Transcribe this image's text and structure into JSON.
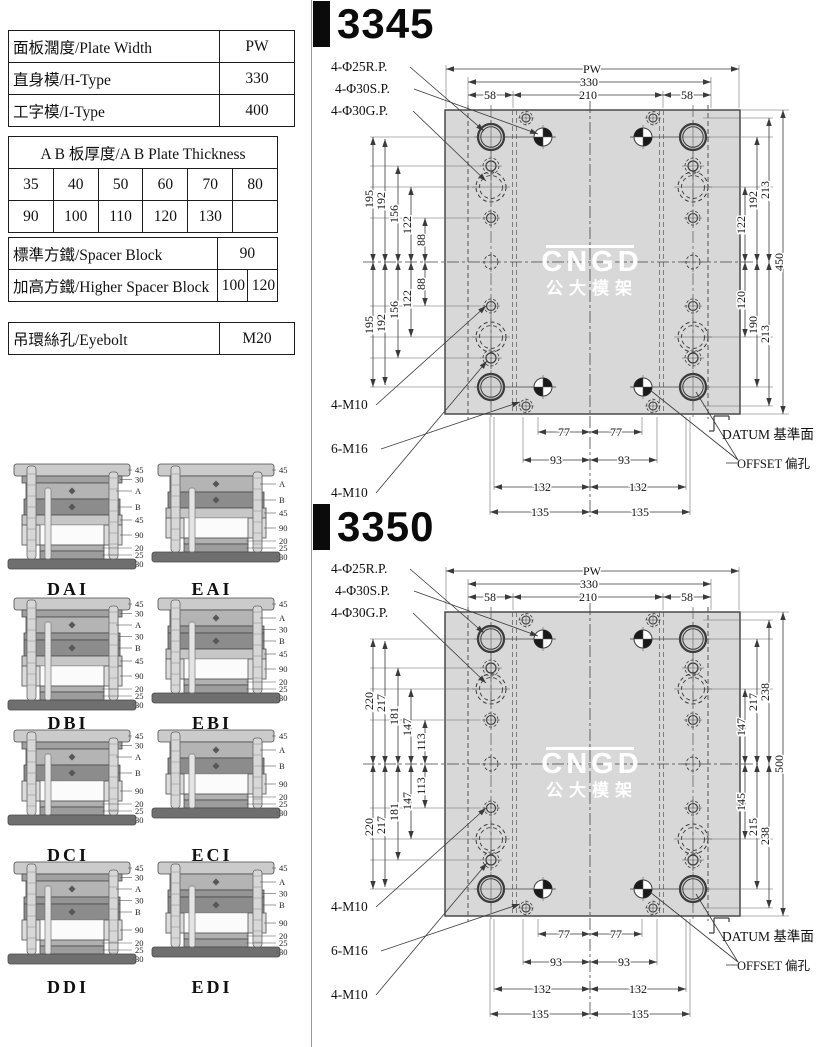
{
  "colors": {
    "plate": "#d8d8d8",
    "line": "#3a3a3a",
    "title_black": "#0b0b0b"
  },
  "spec_table": {
    "rows": [
      {
        "label": "面板濶度/Plate Width",
        "value": "PW"
      },
      {
        "label": "直身模/H-Type",
        "value": "330"
      },
      {
        "label": "工字模/I-Type",
        "value": "400"
      }
    ],
    "ab": {
      "title": "A B 板厚度/A B Plate Thickness",
      "rows": [
        [
          "35",
          "40",
          "50",
          "60",
          "70",
          "80"
        ],
        [
          "90",
          "100",
          "110",
          "120",
          "130",
          ""
        ]
      ]
    },
    "spacer": {
      "standard_label": "標準方鐵/Spacer Block",
      "standard_value": "90",
      "higher_label": "加高方鐵/Higher Spacer Block",
      "higher_values": [
        "100",
        "120"
      ]
    },
    "eyebolt": {
      "label": "吊環絲孔/Eyebolt",
      "value": "M20"
    }
  },
  "molds": [
    {
      "name": "DAI",
      "layers": [
        "45",
        "30",
        "A",
        "B",
        "45",
        "90",
        "20",
        "25",
        "30"
      ]
    },
    {
      "name": "EAI",
      "layers": [
        "45",
        "A",
        "B",
        "45",
        "90",
        "20",
        "25",
        "30"
      ]
    },
    {
      "name": "DBI",
      "layers": [
        "45",
        "30",
        "A",
        "30",
        "B",
        "45",
        "90",
        "20",
        "25",
        "30"
      ]
    },
    {
      "name": "EBI",
      "layers": [
        "45",
        "A",
        "30",
        "B",
        "45",
        "90",
        "20",
        "25",
        "30"
      ]
    },
    {
      "name": "DCI",
      "layers": [
        "45",
        "30",
        "A",
        "B",
        "90",
        "20",
        "25",
        "30"
      ]
    },
    {
      "name": "ECI",
      "layers": [
        "45",
        "A",
        "B",
        "90",
        "20",
        "25",
        "30"
      ]
    },
    {
      "name": "DDI",
      "layers": [
        "45",
        "30",
        "A",
        "30",
        "B",
        "90",
        "20",
        "25",
        "30"
      ]
    },
    {
      "name": "EDI",
      "layers": [
        "45",
        "A",
        "30",
        "B",
        "90",
        "20",
        "25",
        "30"
      ]
    }
  ],
  "drawings": [
    {
      "model": "3345",
      "hole_labels": {
        "rp": "4-Φ25R.P.",
        "sp": "4-Φ30S.P.",
        "gp": "4-Φ30G.P.",
        "m10_top": "4-M10",
        "m16": "6-M16",
        "m10_bottom": "4-M10"
      },
      "datum_label": "DATUM 基準面",
      "offset_label": "OFFSET 偏孔",
      "watermark": {
        "line1": "CNGD",
        "line2": "公大模架"
      },
      "dims_top": {
        "pw": "PW",
        "outer": "330",
        "center": "210",
        "pocket_left": "58",
        "pocket_right": "58"
      },
      "dims_left": [
        "195",
        "192",
        "156",
        "122",
        "88",
        "88",
        "122",
        "156",
        "192",
        "195"
      ],
      "dims_right_top": [
        "213",
        "192",
        "122"
      ],
      "dims_right_bottom": [
        "120",
        "190",
        "213"
      ],
      "dim_total_height": "450",
      "dims_bottom": {
        "d77": [
          "77",
          "77"
        ],
        "d93": [
          "93",
          "93"
        ],
        "d132": [
          "132",
          "132"
        ],
        "d135": [
          "135",
          "135"
        ]
      }
    },
    {
      "model": "3350",
      "hole_labels": {
        "rp": "4-Φ25R.P.",
        "sp": "4-Φ30S.P.",
        "gp": "4-Φ30G.P.",
        "m10_top": "4-M10",
        "m16": "6-M16",
        "m10_bottom": "4-M10"
      },
      "datum_label": "DATUM 基準面",
      "offset_label": "OFFSET 偏孔",
      "watermark": {
        "line1": "CNGD",
        "line2": "公大模架"
      },
      "dims_top": {
        "pw": "PW",
        "outer": "330",
        "center": "210",
        "pocket_left": "58",
        "pocket_right": "58"
      },
      "dims_left": [
        "220",
        "217",
        "181",
        "147",
        "113",
        "113",
        "147",
        "181",
        "217",
        "220"
      ],
      "dims_right_top": [
        "238",
        "217",
        "147"
      ],
      "dims_right_bottom": [
        "145",
        "215",
        "238"
      ],
      "dim_total_height": "500",
      "dims_bottom": {
        "d77": [
          "77",
          "77"
        ],
        "d93": [
          "93",
          "93"
        ],
        "d132": [
          "132",
          "132"
        ],
        "d135": [
          "135",
          "135"
        ]
      }
    }
  ]
}
